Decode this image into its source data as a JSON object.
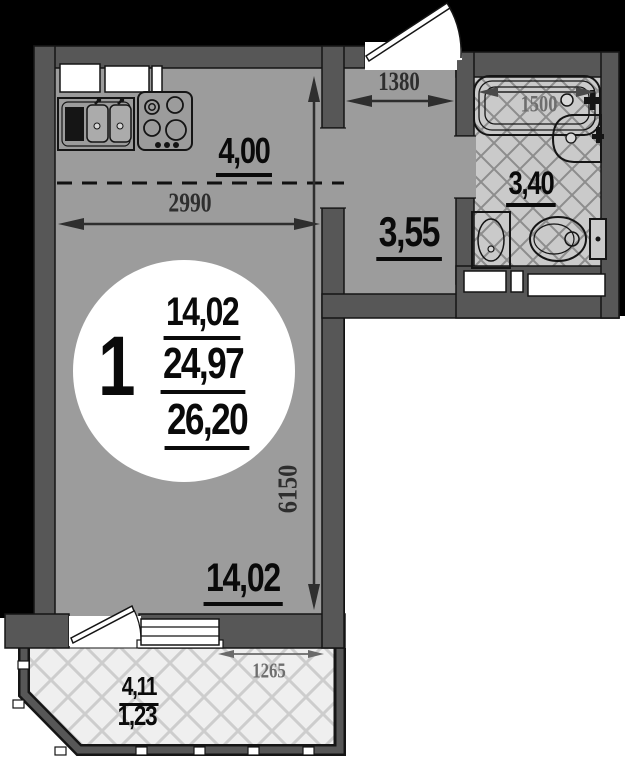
{
  "plan_title": "apartment-floor-plan",
  "unit_badge": {
    "room_count": "1",
    "living_area": "14,02",
    "additional_area": "24,97",
    "total_area": "26,20"
  },
  "areas": {
    "kitchen_zone": "4,00",
    "hallway": "3,55",
    "bathroom": "3,40",
    "living_room": "14,02",
    "balcony_full": "4,11",
    "balcony_reduced": "1,23"
  },
  "dimensions": {
    "living_room_width": "2990",
    "hallway_width": "1380",
    "bathtub_length": "1500",
    "living_room_length": "6150",
    "balcony_window_width": "1265"
  },
  "fixtures": [
    "kitchen-sink-icon",
    "cooktop-icon",
    "bathtub-icon",
    "corner-sink-icon",
    "washbasin-icon",
    "toilet-icon"
  ],
  "colors": {
    "wall": "#575757",
    "floor": "#9c9c9c",
    "bath_tile": "#cacaca",
    "balcony_tile": "#efefef",
    "background_top": "#000000",
    "background_bottom": "#ffffff",
    "badge": "#ffffff",
    "dimension_text": "#2e2e2e",
    "dimension_text_light": "#6e6e6e"
  }
}
